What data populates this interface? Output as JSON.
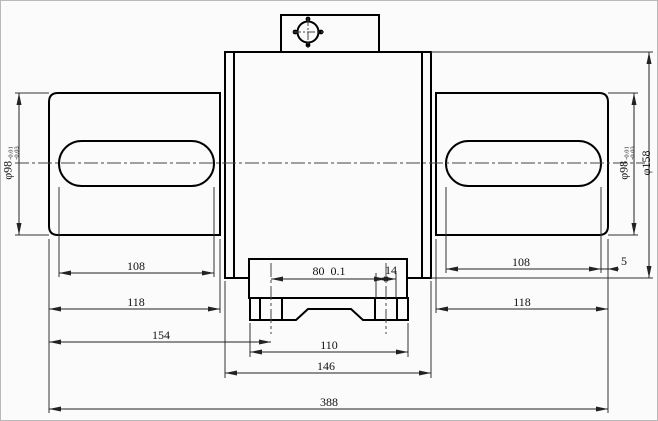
{
  "drawing": {
    "description": "torque-sensor-engineering-drawing",
    "colors": {
      "line": "#000000",
      "dim": "#333333",
      "background": "#fbfbfb"
    },
    "dimensions": {
      "left_shaft_diameter": {
        "value": "φ98",
        "tol_upper": "-0.01",
        "tol_lower": "-0.03"
      },
      "right_shaft_diameter": {
        "value": "φ98",
        "tol_upper": "-0.01",
        "tol_lower": "-0.03"
      },
      "body_diameter": "φ158",
      "left_flat_length": "108",
      "left_shaft_length": "118",
      "left_hole_offset": "154",
      "hole_spacing": "80  0.1",
      "tab_width": "14",
      "base_width": "110",
      "flange_width": "146",
      "overall_length": "388",
      "right_flat_length": "108",
      "right_shaft_length": "118",
      "right_end_offset": "5"
    }
  }
}
